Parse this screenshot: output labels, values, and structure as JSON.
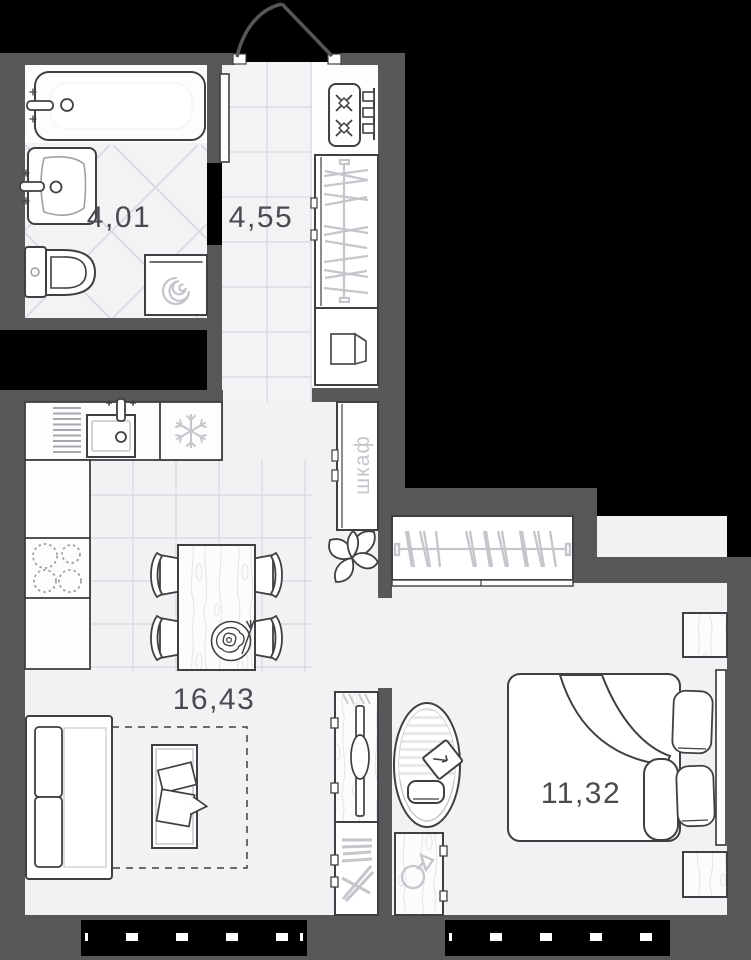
{
  "plan": {
    "title": "studio-apartment-floor-plan",
    "rooms": [
      {
        "id": "bathroom",
        "area_label": "4,01"
      },
      {
        "id": "hallway",
        "area_label": "4,55"
      },
      {
        "id": "kitchen-living-room",
        "area_label": "16,43"
      },
      {
        "id": "bedroom",
        "area_label": "11,32"
      }
    ],
    "wardrobe_label": "шкаф",
    "colors": {
      "background": "#000000",
      "wall": "#58585a",
      "floor": "#f2f2f4",
      "floor_white": "#fdfdfe",
      "tile_line": "#dddde1",
      "furniture_outline": "#3f4043",
      "light_icon": "#c5c6cb",
      "label_text": "#4a4b4f"
    },
    "icons": [
      "bathtub-icon",
      "washbasin-icon",
      "toilet-icon",
      "washing-machine-spiral-icon",
      "entry-door-arc-icon",
      "hob-rings-icon",
      "wall-radiator-icon",
      "hangers-icon",
      "storage-box-icon",
      "dish-rack-icon",
      "kitchen-sink-icon",
      "fridge-snowflake-icon",
      "cooktop-burners-icon",
      "dining-table-icon",
      "chair-icon",
      "plate-fried-egg-icon",
      "sofa-icon",
      "coffee-table-icon",
      "rug-dashed-icon",
      "tv-console-icon",
      "bookshelf-icon",
      "plant-icon",
      "desk-chair-icon",
      "laptop-icon",
      "desk-lamp-icon",
      "bed-icon",
      "pillow-icon",
      "nightstand-icon",
      "window-icon"
    ]
  }
}
